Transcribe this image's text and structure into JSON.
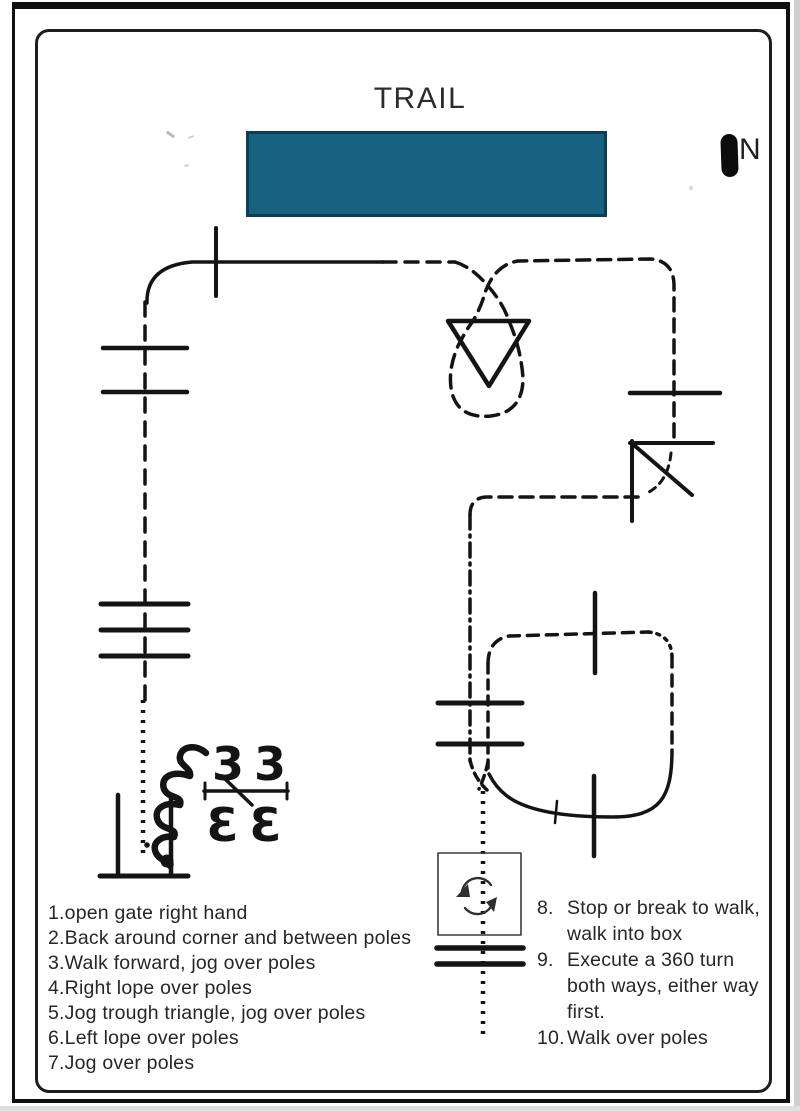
{
  "title": "TRAIL",
  "compass": {
    "label": "N"
  },
  "redaction_box": {
    "color": "#17627F",
    "border_color": "#0E3E55"
  },
  "course": {
    "marker_glyph": "3",
    "line_color": "#141414",
    "box_stroke_color": "#3a3a3a"
  },
  "instructions_left": {
    "items": [
      "1.open gate right hand",
      "2.Back around corner and between poles",
      "3.Walk forward, jog over poles",
      "4.Right lope over poles",
      "5.Jog trough triangle, jog over poles",
      "6.Left lope over poles",
      "7.Jog over poles"
    ]
  },
  "instructions_right": {
    "items": [
      {
        "num": "8.",
        "text": "Stop or break to walk,\nwalk into box"
      },
      {
        "num": "9.",
        "text": "Execute a 360 turn\nboth ways, either way\nfirst."
      },
      {
        "num": "10.",
        "text": "Walk over poles"
      }
    ]
  }
}
